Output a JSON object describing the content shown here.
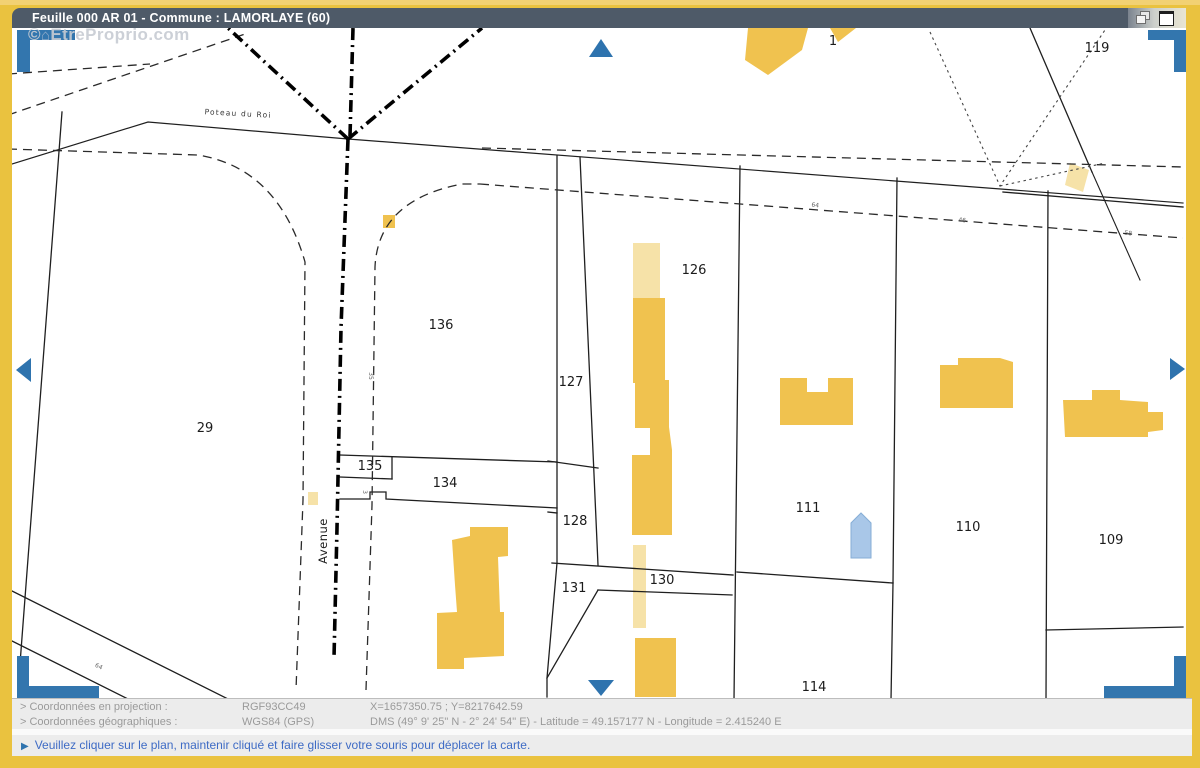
{
  "window": {
    "title": "Feuille 000 AR 01 - Commune : LAMORLAYE (60)"
  },
  "watermark": {
    "symbol": "©",
    "logo_icon": "house-icon",
    "text": "EtreProprio.com"
  },
  "map": {
    "streets": {
      "road": "Poteau du Roi",
      "avenue": "Avenue"
    },
    "parcels": {
      "p1": "1",
      "p119": "119",
      "p126": "126",
      "p136": "136",
      "p127": "127",
      "p29": "29",
      "p135": "135",
      "p134": "134",
      "p128": "128",
      "p131": "131",
      "p130": "130",
      "p111": "111",
      "p110": "110",
      "p109": "109",
      "p114": "114"
    },
    "measures": {
      "top1": "64",
      "top2": "46",
      "top3": "58",
      "bottom_left": "64",
      "avenue1": "35",
      "avenue2": "3"
    },
    "colors": {
      "building": "#F0C24F",
      "building_light": "#F6E2A8",
      "pool": "#A9C7E8",
      "nav_blue": "#2E73AE",
      "frame_yellow": "#EAC23F",
      "titlebar": "#4E5A68"
    }
  },
  "statusbar": {
    "row1": {
      "label": "> Coordonnées en projection :",
      "system": "RGF93CC49",
      "values": "X=1657350.75 ; Y=8217642.59"
    },
    "row2": {
      "label": "> Coordonnées géographiques :",
      "system": "WGS84 (GPS)",
      "values": "DMS (49° 9' 25\" N - 2° 24' 54\" E) - Latitude = 49.157177 N - Longitude = 2.415240 E"
    }
  },
  "instruction": {
    "marker": "▶",
    "text": "Veuillez cliquer sur le plan, maintenir cliqué et faire glisser votre souris pour déplacer la carte."
  }
}
